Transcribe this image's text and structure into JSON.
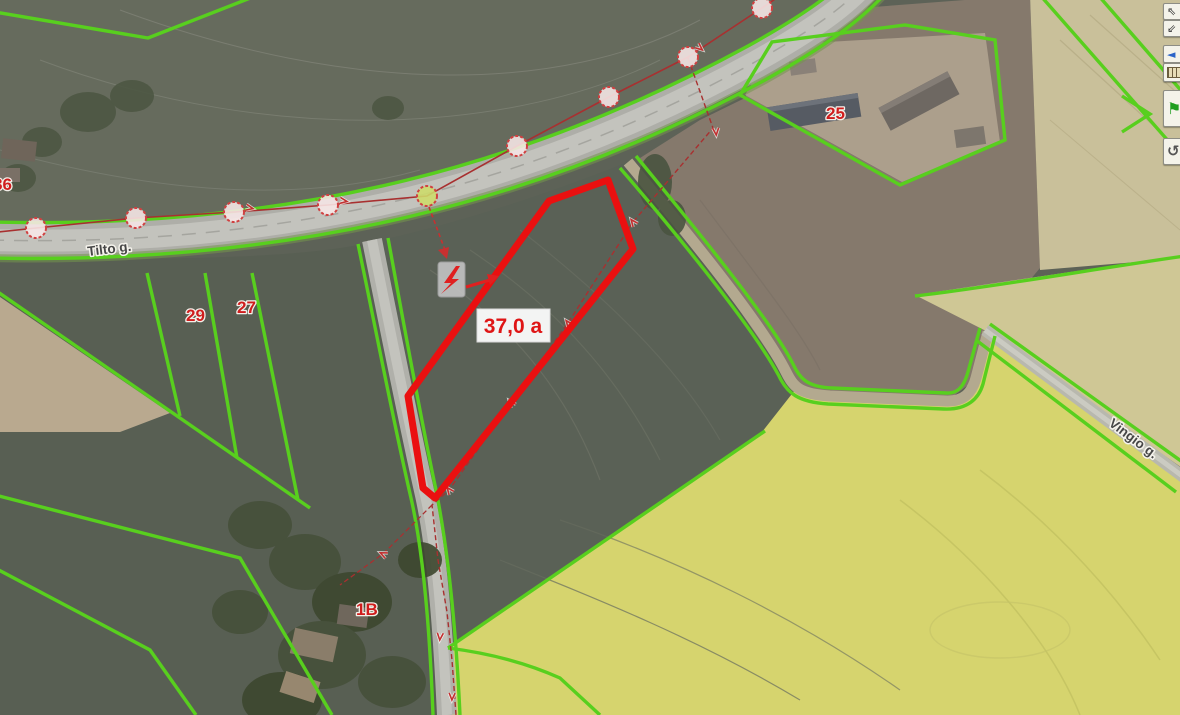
{
  "map": {
    "area_label": "37,0 a",
    "streets": {
      "tilto": "Tilto g.",
      "vingio": "Vingio g."
    },
    "parcels": {
      "n25": "25",
      "n29": "29",
      "n27": "27",
      "n1b": "1B",
      "n86": "86"
    }
  },
  "toolbar": {
    "buttons": [
      {
        "icon": "pan-upper-arrow",
        "glyph": "⇖"
      },
      {
        "icon": "pan-lower-arrow",
        "glyph": "⇙"
      },
      {
        "icon": "back-arrow",
        "glyph": "◄"
      },
      {
        "icon": "ruler",
        "glyph": ""
      },
      {
        "icon": "flag",
        "glyph": "⚑"
      },
      {
        "icon": "rotate",
        "glyph": "↺"
      }
    ]
  },
  "colors": {
    "cadastre_green": "#58cf1e",
    "highlight_red": "#ea1010",
    "power_line_red": "#a83030",
    "label_red": "#cf1d1d",
    "rapeseed_yellow": "#d6d46e",
    "road_gray": "#b2b2ac",
    "field_olive": "#5d6257"
  }
}
